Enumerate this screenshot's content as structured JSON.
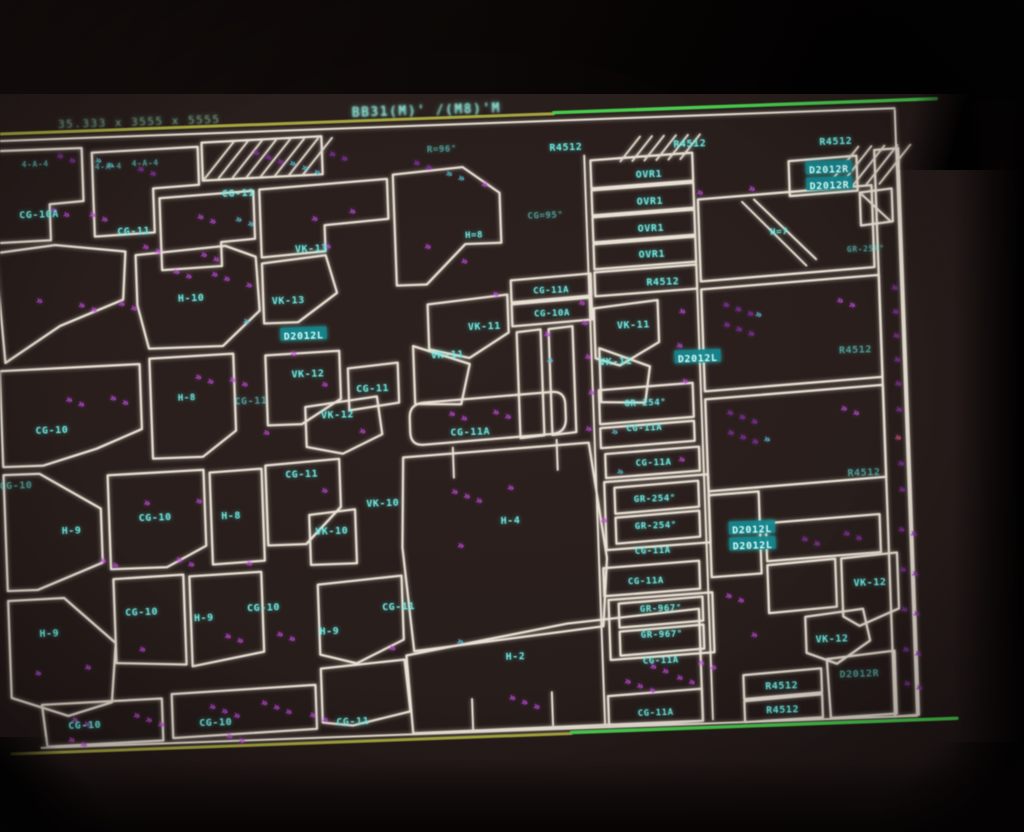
{
  "colors": {
    "screen_background": "#271d1b",
    "outline_white": "#e9e1d4",
    "label_cyan": "#6fe9e0",
    "marker_magenta": "#c44ae2",
    "marker_purple": "#8c2fb2",
    "marker_teal": "#3fd2ca",
    "marker_red": "#e0507a",
    "guide_olive": "#a6a63c",
    "guide_green": "#44cf4a",
    "highlight_bg": "#11838d",
    "bezel_black": "#000000"
  },
  "status_bar": {
    "left_text": "35.333 x 3555 x 5555",
    "right_text": "BB31(M)' /(M8)'M"
  },
  "drawing": {
    "part_labels": [
      {
        "t": "4-A-4",
        "x": 45,
        "y": 163,
        "s": 8,
        "d": 1
      },
      {
        "t": "4-A-4",
        "x": 118,
        "y": 168,
        "s": 8,
        "d": 1
      },
      {
        "t": "4-A-4",
        "x": 155,
        "y": 166,
        "s": 8,
        "d": 1
      },
      {
        "t": "R=96°",
        "x": 452,
        "y": 163,
        "s": 9,
        "d": 1
      },
      {
        "t": "R4512",
        "x": 576,
        "y": 166
      },
      {
        "t": "R4512",
        "x": 700,
        "y": 167
      },
      {
        "t": "R4512",
        "x": 846,
        "y": 170
      },
      {
        "t": "OVR1",
        "x": 658,
        "y": 196
      },
      {
        "t": "OVR1",
        "x": 658,
        "y": 223
      },
      {
        "t": "OVR1",
        "x": 658,
        "y": 250
      },
      {
        "t": "OVR1",
        "x": 658,
        "y": 276
      },
      {
        "t": "R4512",
        "x": 668,
        "y": 304
      },
      {
        "t": "D2012R",
        "x": 838,
        "y": 198,
        "hl": 1
      },
      {
        "t": "D2012R",
        "x": 838,
        "y": 214,
        "hl": 1
      },
      {
        "t": "H=7",
        "x": 786,
        "y": 258,
        "s": 9
      },
      {
        "t": "GR-254°",
        "x": 872,
        "y": 278,
        "s": 8,
        "d": 1
      },
      {
        "t": "CG-10A",
        "x": 47,
        "y": 214
      },
      {
        "t": "CG-11",
        "x": 141,
        "y": 234
      },
      {
        "t": "CG-11",
        "x": 247,
        "y": 200
      },
      {
        "t": "CG=95°",
        "x": 553,
        "y": 233,
        "s": 9,
        "d": 1
      },
      {
        "t": "H=8",
        "x": 481,
        "y": 250,
        "s": 9
      },
      {
        "t": "CG-11A",
        "x": 556,
        "y": 308,
        "s": 9
      },
      {
        "t": "CG-10A",
        "x": 556,
        "y": 331,
        "s": 9
      },
      {
        "t": "VK-13",
        "x": 318,
        "y": 258
      },
      {
        "t": "H-10",
        "x": 196,
        "y": 303
      },
      {
        "t": "VK-13",
        "x": 293,
        "y": 309
      },
      {
        "t": "VK-11",
        "x": 488,
        "y": 342
      },
      {
        "t": "VK-11",
        "x": 450,
        "y": 369
      },
      {
        "t": "VK-11",
        "x": 637,
        "y": 346
      },
      {
        "t": "VK-11",
        "x": 618,
        "y": 382
      },
      {
        "t": "D2012L",
        "x": 307,
        "y": 345,
        "hl": 1
      },
      {
        "t": "D2012L",
        "x": 700,
        "y": 382,
        "hl": 1
      },
      {
        "t": "VK-12",
        "x": 310,
        "y": 383
      },
      {
        "t": "CG-11",
        "x": 374,
        "y": 400
      },
      {
        "t": "CG-11",
        "x": 252,
        "y": 408,
        "d": 1
      },
      {
        "t": "VK-12",
        "x": 338,
        "y": 425
      },
      {
        "t": "H-8",
        "x": 188,
        "y": 402,
        "s": 9
      },
      {
        "t": "CG-10",
        "x": 52,
        "y": 430
      },
      {
        "t": "GR-254°",
        "x": 646,
        "y": 424,
        "s": 9
      },
      {
        "t": "CG-11A",
        "x": 644,
        "y": 449,
        "s": 9
      },
      {
        "t": "CG-11A",
        "x": 470,
        "y": 447
      },
      {
        "t": "R4512",
        "x": 858,
        "y": 379,
        "d": 1
      },
      {
        "t": "CG-10",
        "x": 14,
        "y": 484,
        "d": 1
      },
      {
        "t": "CG-11",
        "x": 300,
        "y": 483
      },
      {
        "t": "H-9",
        "x": 68,
        "y": 531
      },
      {
        "t": "CG-10",
        "x": 152,
        "y": 521
      },
      {
        "t": "H-8",
        "x": 228,
        "y": 522
      },
      {
        "t": "VK-10",
        "x": 380,
        "y": 515
      },
      {
        "t": "VK-10",
        "x": 328,
        "y": 541
      },
      {
        "t": "H-4",
        "x": 507,
        "y": 537
      },
      {
        "t": "CG-11A",
        "x": 652,
        "y": 484,
        "s": 9
      },
      {
        "t": "GR-254°",
        "x": 652,
        "y": 520,
        "s": 9
      },
      {
        "t": "GR-254°",
        "x": 652,
        "y": 547,
        "s": 9
      },
      {
        "t": "CG-11A",
        "x": 648,
        "y": 572,
        "s": 9
      },
      {
        "t": "CG-11A",
        "x": 640,
        "y": 602,
        "s": 9
      },
      {
        "t": "R4512",
        "x": 862,
        "y": 502,
        "d": 1
      },
      {
        "t": "D2012L",
        "x": 748,
        "y": 555,
        "hl": 1
      },
      {
        "t": "D2012L",
        "x": 748,
        "y": 571,
        "hl": 1
      },
      {
        "t": "VK-12",
        "x": 864,
        "y": 612
      },
      {
        "t": "H-9",
        "x": 42,
        "y": 633
      },
      {
        "t": "CG-10",
        "x": 135,
        "y": 615
      },
      {
        "t": "H-9",
        "x": 197,
        "y": 623
      },
      {
        "t": "CG-10",
        "x": 257,
        "y": 615
      },
      {
        "t": "H-9",
        "x": 322,
        "y": 641
      },
      {
        "t": "CG-11",
        "x": 392,
        "y": 619
      },
      {
        "t": "H-2",
        "x": 507,
        "y": 673
      },
      {
        "t": "GR-967°",
        "x": 654,
        "y": 630,
        "s": 9
      },
      {
        "t": "GR-967°",
        "x": 654,
        "y": 656,
        "s": 9
      },
      {
        "t": "CG-11A",
        "x": 652,
        "y": 682,
        "s": 9
      },
      {
        "t": "VK-12",
        "x": 824,
        "y": 667
      },
      {
        "t": "D2012R",
        "x": 850,
        "y": 703,
        "d": 1
      },
      {
        "t": "R4512",
        "x": 772,
        "y": 712
      },
      {
        "t": "R4512",
        "x": 772,
        "y": 736
      },
      {
        "t": "CG-10",
        "x": 74,
        "y": 726
      },
      {
        "t": "CG-10",
        "x": 205,
        "y": 728
      },
      {
        "t": "CG-11",
        "x": 342,
        "y": 732
      },
      {
        "t": "CG-11A",
        "x": 645,
        "y": 734,
        "s": 9
      }
    ],
    "markers": [
      [
        66,
        158,
        2,
        "p"
      ],
      [
        104,
        164,
        2,
        "t"
      ],
      [
        146,
        174,
        2,
        "p"
      ],
      [
        262,
        162,
        3,
        "p"
      ],
      [
        298,
        174,
        3,
        "t"
      ],
      [
        338,
        166,
        2,
        "p"
      ],
      [
        422,
        178,
        2,
        "p"
      ],
      [
        454,
        190,
        2,
        "t"
      ],
      [
        489,
        202,
        1,
        "m"
      ],
      [
        704,
        218,
        1,
        "m"
      ],
      [
        756,
        216,
        1,
        "m"
      ],
      [
        58,
        212,
        2,
        "m"
      ],
      [
        96,
        218,
        2,
        "m"
      ],
      [
        204,
        224,
        2,
        "m"
      ],
      [
        242,
        228,
        2,
        "t"
      ],
      [
        148,
        252,
        2,
        "m"
      ],
      [
        206,
        262,
        2,
        "m"
      ],
      [
        318,
        230,
        1,
        "m"
      ],
      [
        356,
        224,
        1,
        "m"
      ],
      [
        430,
        262,
        1,
        "m"
      ],
      [
        466,
        278,
        1,
        "m"
      ],
      [
        496,
        312,
        1,
        "m"
      ],
      [
        582,
        324,
        1,
        "m"
      ],
      [
        178,
        278,
        2,
        "m"
      ],
      [
        216,
        282,
        2,
        "m"
      ],
      [
        82,
        308,
        2,
        "m"
      ],
      [
        122,
        308,
        2,
        "m"
      ],
      [
        40,
        302,
        1,
        "m"
      ],
      [
        250,
        294,
        1,
        "m"
      ],
      [
        330,
        258,
        1,
        "m"
      ],
      [
        246,
        330,
        1,
        "t"
      ],
      [
        546,
        354,
        1,
        "m"
      ],
      [
        548,
        380,
        1,
        "t"
      ],
      [
        584,
        344,
        1,
        "m"
      ],
      [
        586,
        378,
        1,
        "m"
      ],
      [
        588,
        414,
        1,
        "m"
      ],
      [
        584,
        450,
        1,
        "m"
      ],
      [
        66,
        402,
        2,
        "m"
      ],
      [
        110,
        402,
        2,
        "m"
      ],
      [
        196,
        384,
        2,
        "m"
      ],
      [
        230,
        388,
        2,
        "m"
      ],
      [
        292,
        364,
        1,
        "m"
      ],
      [
        322,
        396,
        1,
        "m"
      ],
      [
        262,
        442,
        1,
        "m"
      ],
      [
        358,
        444,
        1,
        "m"
      ],
      [
        448,
        430,
        2,
        "m"
      ],
      [
        492,
        430,
        2,
        "m"
      ],
      [
        682,
        336,
        1,
        "m"
      ],
      [
        678,
        370,
        1,
        "m"
      ],
      [
        682,
        406,
        1,
        "m"
      ],
      [
        610,
        454,
        1,
        "t"
      ],
      [
        676,
        484,
        1,
        "m"
      ],
      [
        614,
        494,
        1,
        "t"
      ],
      [
        726,
        331,
        3,
        "p"
      ],
      [
        726,
        351,
        3,
        "p"
      ],
      [
        758,
        342,
        1,
        "t"
      ],
      [
        840,
        331,
        2,
        "m"
      ],
      [
        726,
        439,
        3,
        "p"
      ],
      [
        726,
        459,
        3,
        "p"
      ],
      [
        762,
        467,
        1,
        "t"
      ],
      [
        840,
        439,
        2,
        "m"
      ],
      [
        895,
        320,
        1,
        "p"
      ],
      [
        895,
        344,
        1,
        "p"
      ],
      [
        895,
        368,
        1,
        "p"
      ],
      [
        895,
        392,
        1,
        "p"
      ],
      [
        895,
        416,
        1,
        "p"
      ],
      [
        895,
        442,
        1,
        "p"
      ],
      [
        893,
        470,
        1,
        "r"
      ],
      [
        895,
        496,
        1,
        "p"
      ],
      [
        895,
        522,
        1,
        "p"
      ],
      [
        140,
        508,
        1,
        "m"
      ],
      [
        192,
        508,
        1,
        "m"
      ],
      [
        318,
        502,
        1,
        "m"
      ],
      [
        452,
        562,
        1,
        "m"
      ],
      [
        94,
        564,
        2,
        "m"
      ],
      [
        170,
        566,
        2,
        "m"
      ],
      [
        240,
        572,
        1,
        "m"
      ],
      [
        596,
        542,
        1,
        "m"
      ],
      [
        448,
        508,
        3,
        "m"
      ],
      [
        504,
        506,
        1,
        "m"
      ],
      [
        216,
        644,
        2,
        "m"
      ],
      [
        268,
        644,
        2,
        "m"
      ],
      [
        130,
        654,
        1,
        "m"
      ],
      [
        380,
        662,
        1,
        "m"
      ],
      [
        25,
        674,
        1,
        "m"
      ],
      [
        75,
        670,
        1,
        "m"
      ],
      [
        448,
        658,
        1,
        "t"
      ],
      [
        640,
        690,
        2,
        "m"
      ],
      [
        688,
        688,
        2,
        "m"
      ],
      [
        498,
        716,
        3,
        "m"
      ],
      [
        796,
        568,
        2,
        "p"
      ],
      [
        838,
        564,
        2,
        "p"
      ],
      [
        718,
        622,
        2,
        "m"
      ],
      [
        742,
        662,
        1,
        "m"
      ],
      [
        60,
        722,
        2,
        "m"
      ],
      [
        122,
        720,
        3,
        "m"
      ],
      [
        198,
        714,
        3,
        "m"
      ],
      [
        250,
        712,
        3,
        "m"
      ],
      [
        614,
        704,
        3,
        "m"
      ],
      [
        666,
        702,
        2,
        "m"
      ],
      [
        298,
        726,
        2,
        "m"
      ],
      [
        893,
        562,
        2,
        "p"
      ],
      [
        893,
        602,
        2,
        "p"
      ],
      [
        893,
        642,
        2,
        "p"
      ],
      [
        893,
        682,
        2,
        "p"
      ],
      [
        893,
        716,
        2,
        "p"
      ],
      [
        56,
        742,
        2,
        "m"
      ],
      [
        214,
        744,
        2,
        "m"
      ]
    ],
    "parts": [
      "M2,149 L92,149 L92,202 L58,204 L58,240 L2,241 Z",
      "M2,251 L62,245 L132,254 L128,302 L64,326 L8,361 Z",
      "M2,369 L142,367 L142,432 L96,450 L42,465 L2,465 Z",
      "M2,473 L38,473 L98,510 L98,564 L32,589 L2,589 Z",
      "M2,599 L58,598 L108,645 L102,704 L58,716 L2,696 Z",
      "M32,704 L152,702 L152,744 L36,746 Z",
      "M102,154 L208,152 L208,190 L162,192 L162,236 L102,238 Z",
      "M212,148 L332,146 L332,184 L212,186 Z",
      "M168,202 L262,198 L262,246 L228,248 L228,272 L168,274 Z",
      "M142,258 L232,252 L262,264 L264,318 L226,352 L152,352 L142,308 Z",
      "M152,362 L236,360 L236,437 L202,462 L152,462 Z",
      "M106,477 L202,475 L202,551 L162,571 L106,571 Z",
      "M208,478 L260,476 L260,568 L208,570 Z",
      "M108,581 L178,579 L178,669 L108,665 Z",
      "M184,581 L256,579 L256,659 L184,671 Z",
      "M162,698 L306,694 L306,738 L162,742 Z",
      "M268,197 L396,191 L396,231 L332,235 L332,261 L268,265 Z",
      "M268,271 L332,265 L342,303 L302,331 L268,331 Z",
      "M268,363 L342,361 L342,409 L302,433 L268,433 Z",
      "M306,416 L378,408 L382,446 L342,464 L306,456 Z",
      "M350,379 L400,375 L400,415 L350,421 Z",
      "M264,473 L338,469 L338,517 L302,553 L264,553 Z",
      "M306,524 L352,520 L352,574 L306,574 Z",
      "M312,594 L396,588 L396,652 L348,674 L312,664 Z",
      "M312,678 L396,672 L400,724 L342,736 L312,732 Z",
      "M402,187 L472,182 L508,209 L508,259 L472,259 L432,298 L402,298 Z",
      "M432,318 L512,311 L512,349 L472,373 L432,363 Z",
      "M416,359 L472,379 L462,419 L416,417 Z",
      "M424,416 L552,410 Q566,409 566,423 L566,437 Q566,451 552,452 L424,458 Q410,459 410,445 L410,431 Q410,417 424,416 Z",
      "M402,470 L588,462 L602,578 L596,646 L470,658 L406,664 L398,560 Z",
      "M398,668 L560,642 L692,632 L692,744 L402,746 Z",
      "M516,297 L596,293 L596,315 L516,319 Z",
      "M516,321 L596,317 L596,339 L516,343 Z",
      "M520,349 L544,347 L544,453 L520,455 Z",
      "M552,347 L576,345 L576,451 L552,453 Z",
      "M600,180 L702,176 L702,204 L600,208 Z",
      "M600,210 L702,206 L702,231 L600,235 Z",
      "M600,237 L702,233 L702,258 L600,262 Z",
      "M600,264 L702,260 L702,285 L600,289 Z",
      "M600,292 L702,288 L702,312 L600,316 Z",
      "M598,328 L662,322 L662,364 L622,386 L598,378 Z",
      "M602,368 L652,388 L646,424 L602,422 Z",
      "M600,410 L694,406 L694,440 L600,444 Z",
      "M600,448 L694,444 L694,464 L600,468 Z",
      "M604,474 L698,470 L698,494 L604,498 Z",
      "M602,502 L706,498 L706,566 L602,570 Z",
      "M612,508 L696,504 L696,530 L612,534 Z",
      "M612,538 L696,534 L696,560 L612,564 Z",
      "M598,588 L694,584 L694,612 L598,616 Z",
      "M602,620 L706,616 L706,676 L602,680 Z",
      "M612,624 L696,620 L696,644 L612,648 Z",
      "M612,652 L696,648 L696,672 L612,676 Z",
      "M598,716 L692,712 L692,744 L598,747 Z",
      "M798,188 L866,185 L866,220 L798,223 Z",
      "M706,223 L880,215 L880,297 L706,305 Z",
      "M706,313 L884,305 L884,407 L706,415 Z",
      "M706,423 L884,415 L884,507 L706,515 Z",
      "M884,180 L908,179 L908,746 L884,747 Z",
      "M868,222 L900,219 L900,252 L868,255 Z",
      "M706,519 L756,517 L756,599 L706,601 Z",
      "M762,549 L876,544 L876,582 L762,587 Z",
      "M762,591 L830,587 L830,635 L762,639 Z",
      "M836,587 L892,583 L892,639 L852,655 L836,645 Z",
      "M798,644 L856,638 L862,670 L828,692 L798,680 Z",
      "M734,700 L812,696 L812,720 L734,724 Z",
      "M734,726 L812,722 L812,745 L734,747 Z",
      "M818,687 L886,681 L886,744 L820,746 Z"
    ],
    "aux_lines": [
      "M0,139 L906,139",
      "M30,747 L906,747",
      "M906,141 L906,747",
      "M594,175 L594,745",
      "M702,208 L702,743",
      "M452,462 L452,492",
      "M556,458 L556,488",
      "M462,714 L462,746",
      "M542,710 L542,743",
      "M750,227 L812,293",
      "M762,225 L822,287",
      "M870,224 L898,252"
    ],
    "hatches": [
      {
        "x": 214,
        "y": 148,
        "w": 118,
        "h": 36,
        "step": 14
      },
      {
        "x": 630,
        "y": 158,
        "w": 70,
        "h": 24,
        "step": 12
      },
      {
        "x": 836,
        "y": 176,
        "w": 66,
        "h": 38,
        "step": 13
      }
    ],
    "guides": [
      {
        "x1": 0,
        "y1": 132,
        "x2": 565,
        "y2": 132,
        "c": "#a6a63c",
        "w": 3
      },
      {
        "x1": 565,
        "y1": 131,
        "x2": 948,
        "y2": 131,
        "c": "#44cf4a",
        "w": 3.4
      },
      {
        "x1": 0,
        "y1": 752,
        "x2": 560,
        "y2": 752,
        "c": "#a6a63c",
        "w": 3
      },
      {
        "x1": 560,
        "y1": 751,
        "x2": 946,
        "y2": 751,
        "c": "#44cf4a",
        "w": 3.4
      }
    ]
  }
}
